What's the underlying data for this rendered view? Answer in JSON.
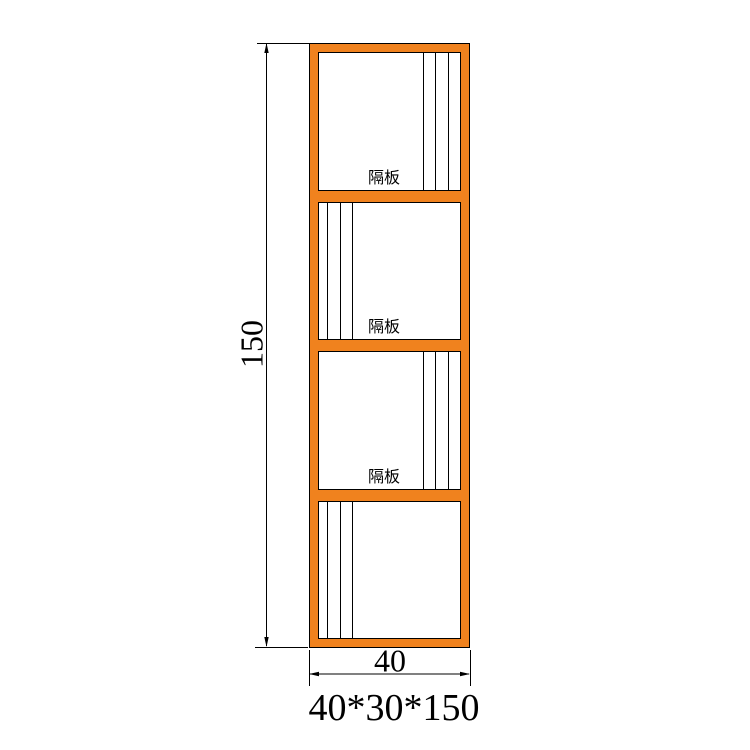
{
  "colors": {
    "frame-orange": "#F0821E",
    "line-black": "#000000",
    "text-black": "#000000",
    "background": "#ffffff"
  },
  "drawing": {
    "product_size_label": "40*30*150",
    "height_dimension": {
      "value": "150"
    },
    "width_dimension": {
      "value": "40"
    },
    "compartments": [
      {
        "label": "隔板",
        "lines_side": "right"
      },
      {
        "label": "隔板",
        "lines_side": "left"
      },
      {
        "label": "隔板",
        "lines_side": "right"
      },
      {
        "label": "",
        "lines_side": "left"
      }
    ]
  }
}
